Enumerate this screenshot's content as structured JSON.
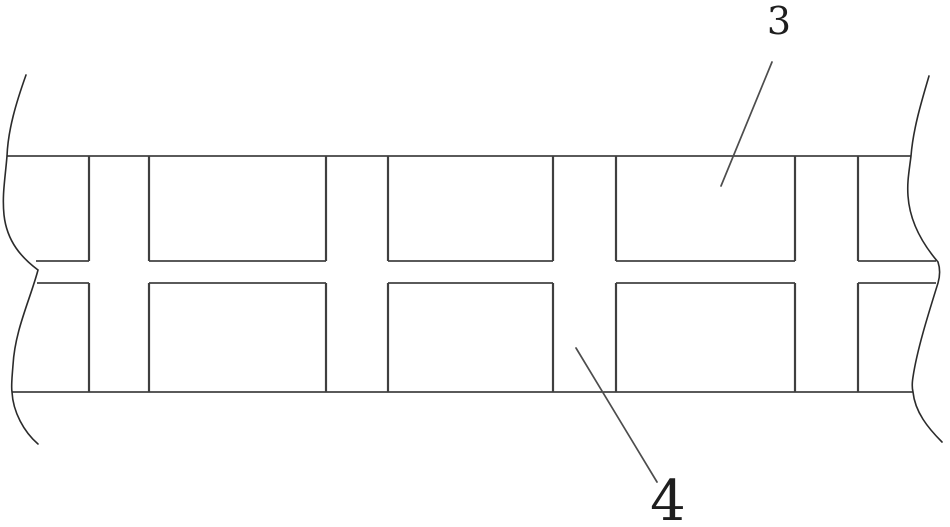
{
  "figure": {
    "colors": {
      "background": "#ffffff",
      "horizontal_line": "#242424",
      "vertical_line": "#3f3f3f",
      "break_line": "#2b2b2b",
      "leader_line": "#4d4d4d",
      "label_text": "#1e1e1e"
    },
    "labels": {
      "ref3": {
        "text": "3",
        "x": 779,
        "y": 21,
        "font_size": 38
      },
      "ref4": {
        "text": "4",
        "x": 668,
        "y": 502,
        "font_size": 56
      }
    },
    "drawing": {
      "canvas": {
        "width": 950,
        "height": 527
      },
      "top_line": {
        "x1": 7,
        "x2": 911,
        "y": 156
      },
      "bottom_line": {
        "x1": 12,
        "x2": 913,
        "y": 392
      },
      "verticals_x": [
        89,
        149,
        326,
        388,
        553,
        616,
        795,
        858
      ],
      "row1": {
        "y_top": 156,
        "y_bottom": 261,
        "edge_segments": [
          [
            36,
            89
          ],
          [
            149,
            326
          ],
          [
            388,
            553
          ],
          [
            616,
            795
          ],
          [
            858,
            936
          ]
        ]
      },
      "row2": {
        "y_top": 283,
        "y_bottom": 392,
        "edge_segments": [
          [
            37,
            89
          ],
          [
            149,
            326
          ],
          [
            388,
            553
          ],
          [
            616,
            795
          ],
          [
            858,
            936
          ]
        ]
      },
      "break_left_path": "M 26 75 C 16 103 8 130 7 156 C 5 180 2 195 4 215 C 7 242 22 258 38 270 C 30 300 15 330 13 365 C 12 378 11 386 12 392 C 13 412 24 432 38 444",
      "break_right_path": "M 929 76 C 921 103 913 130 911 156 C 909 172 907 182 908 196 C 910 225 926 248 938 262 C 940 268 940 276 938 283 C 928 315 917 350 913 377 C 912 383 912 388 913 392 C 915 412 928 428 942 442",
      "leaders": {
        "ref3": {
          "x1": 772,
          "y1": 62,
          "x2": 721,
          "y2": 186
        },
        "ref4": {
          "x1": 576,
          "y1": 348,
          "x2": 657,
          "y2": 482
        }
      }
    }
  }
}
